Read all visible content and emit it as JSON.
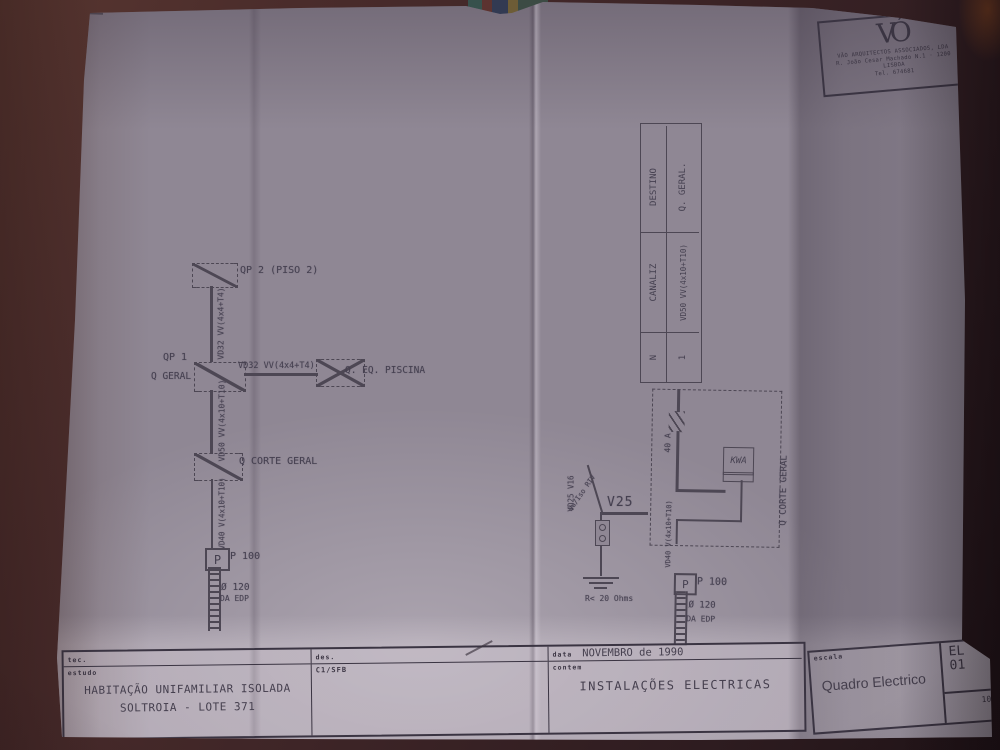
{
  "logo": {
    "mark": "VÓ",
    "firm": "VÃO ARQUITECTOS ASSOCIADOS, LDA",
    "address": "R. João Cesar Machado N.1 · 1200 LISBOA",
    "phone": "Tel. 674681"
  },
  "cable_table": {
    "header": {
      "n": "N",
      "canaliz": "CANALIZ",
      "destino": "DESTINO"
    },
    "row1": {
      "n": "1",
      "canaliz": "VD50 VV(4x10+T10)",
      "destino": "Q. GERAL."
    }
  },
  "schematic": {
    "qp2_label": "QP 2 (PISO 2)",
    "qp2_feed": "VD32 VV(4x4+T4)",
    "qp1_label": "QP 1",
    "qp1_sub": "Q GERAL",
    "piscina_feed": "VD32 VV(4x4+T4)",
    "piscina_label": "Q. EQ. PISCINA",
    "corte_feed": "VD50 VV(4x10+T10)",
    "corte_label": "Q CORTE GERAL",
    "p_feed": "VD40 V(4x10+T10)",
    "p_letter": "P",
    "p_label": "P 100",
    "duct_label": "Ø 120",
    "duct_sub": "DA EDP"
  },
  "earth": {
    "cable": "VD25 V16",
    "note": "Nu/Iso RIV",
    "tag": "V25",
    "resistance": "R< 20 Ohms"
  },
  "meter": {
    "amp": "40 A",
    "kwa": "KWA",
    "corte_label": "Q CORTE GERAL",
    "cable": "VD40 V(4x10+T10)",
    "p_letter": "P",
    "p_label": "P 100",
    "duct_label": "Ø 120",
    "duct_sub": "DA EDP"
  },
  "titleblock": {
    "tec_label": "tec.",
    "estudo_label": "estudo",
    "project_line1": "HABITAÇÃO UNIFAMILIAR ISOLADA",
    "project_line2": "SOLTROIA - LOTE 371",
    "des_label": "des.",
    "des_value": "C1/SFB",
    "data_label": "data",
    "data_value": "NOVEMBRO de 1990",
    "contem_label": "contem",
    "contem_value": "INSTALAÇÕES ELECTRICAS",
    "escala_label": "escala",
    "drawing_title": "Quadro Electrico",
    "code_line1": "EL",
    "code_line2": "01",
    "sheet_number": "10"
  }
}
